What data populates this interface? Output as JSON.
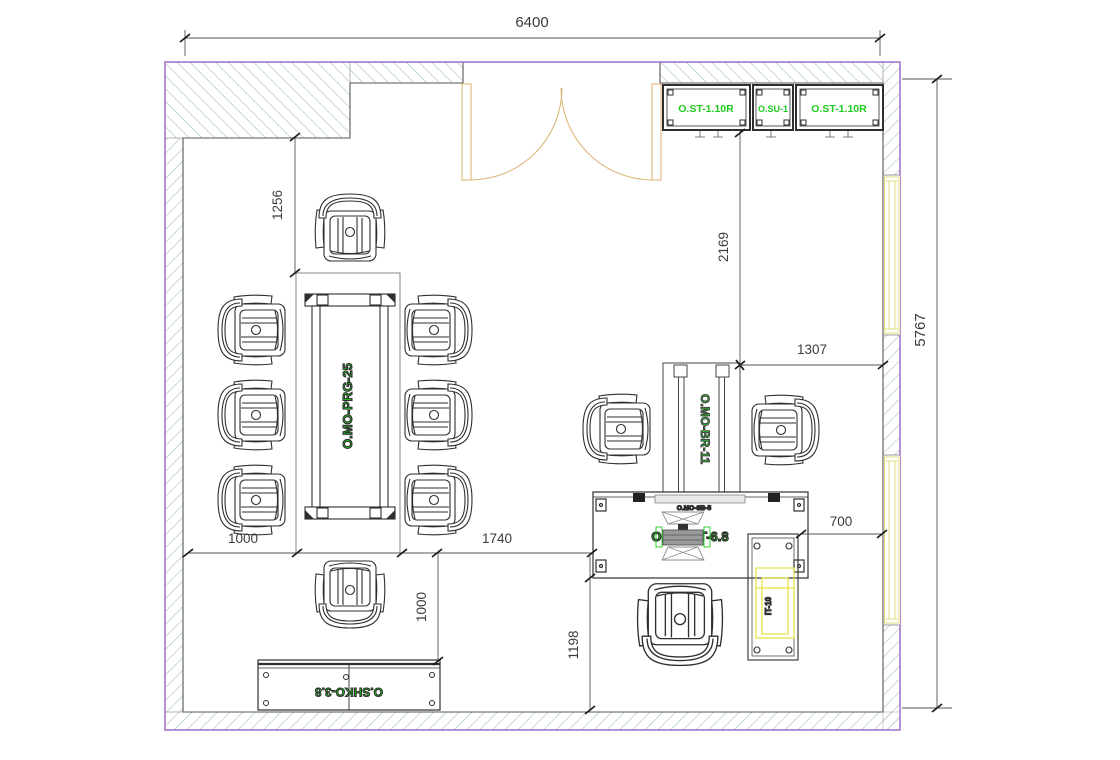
{
  "drawing": {
    "dims": {
      "width_top": "6400",
      "height_right": "5767",
      "left_clearance": "1256",
      "door_to_zone": "2169",
      "zone_to_wall": "1307",
      "chain_left": "1000",
      "chain_mid": "1740",
      "table_to_cabinet": "1000",
      "desk_to_wall": "1198",
      "return_width": "700"
    },
    "furniture": {
      "cabinet_tall_left": "O.ST-1.10R",
      "cabinet_upper": "O.SU-1",
      "cabinet_tall_right": "O.ST-1.10R",
      "meeting_table": "O.MO-PRG-25",
      "barrier": "O.MO-BR-11",
      "desk": "O.MO-ST-6.8",
      "desk_accessory": "O.MO-SB-5",
      "it_unit": "IT-10",
      "sideboard": "O.SHKO-3.8"
    },
    "colors": {
      "hatch": "#93b8ae",
      "boundary": "#a06cc8",
      "label_green": "#1ecb1e",
      "door_tan": "#ddb77a",
      "window_yellow": "#e3dc7d",
      "line": "#3c3c3c"
    }
  }
}
